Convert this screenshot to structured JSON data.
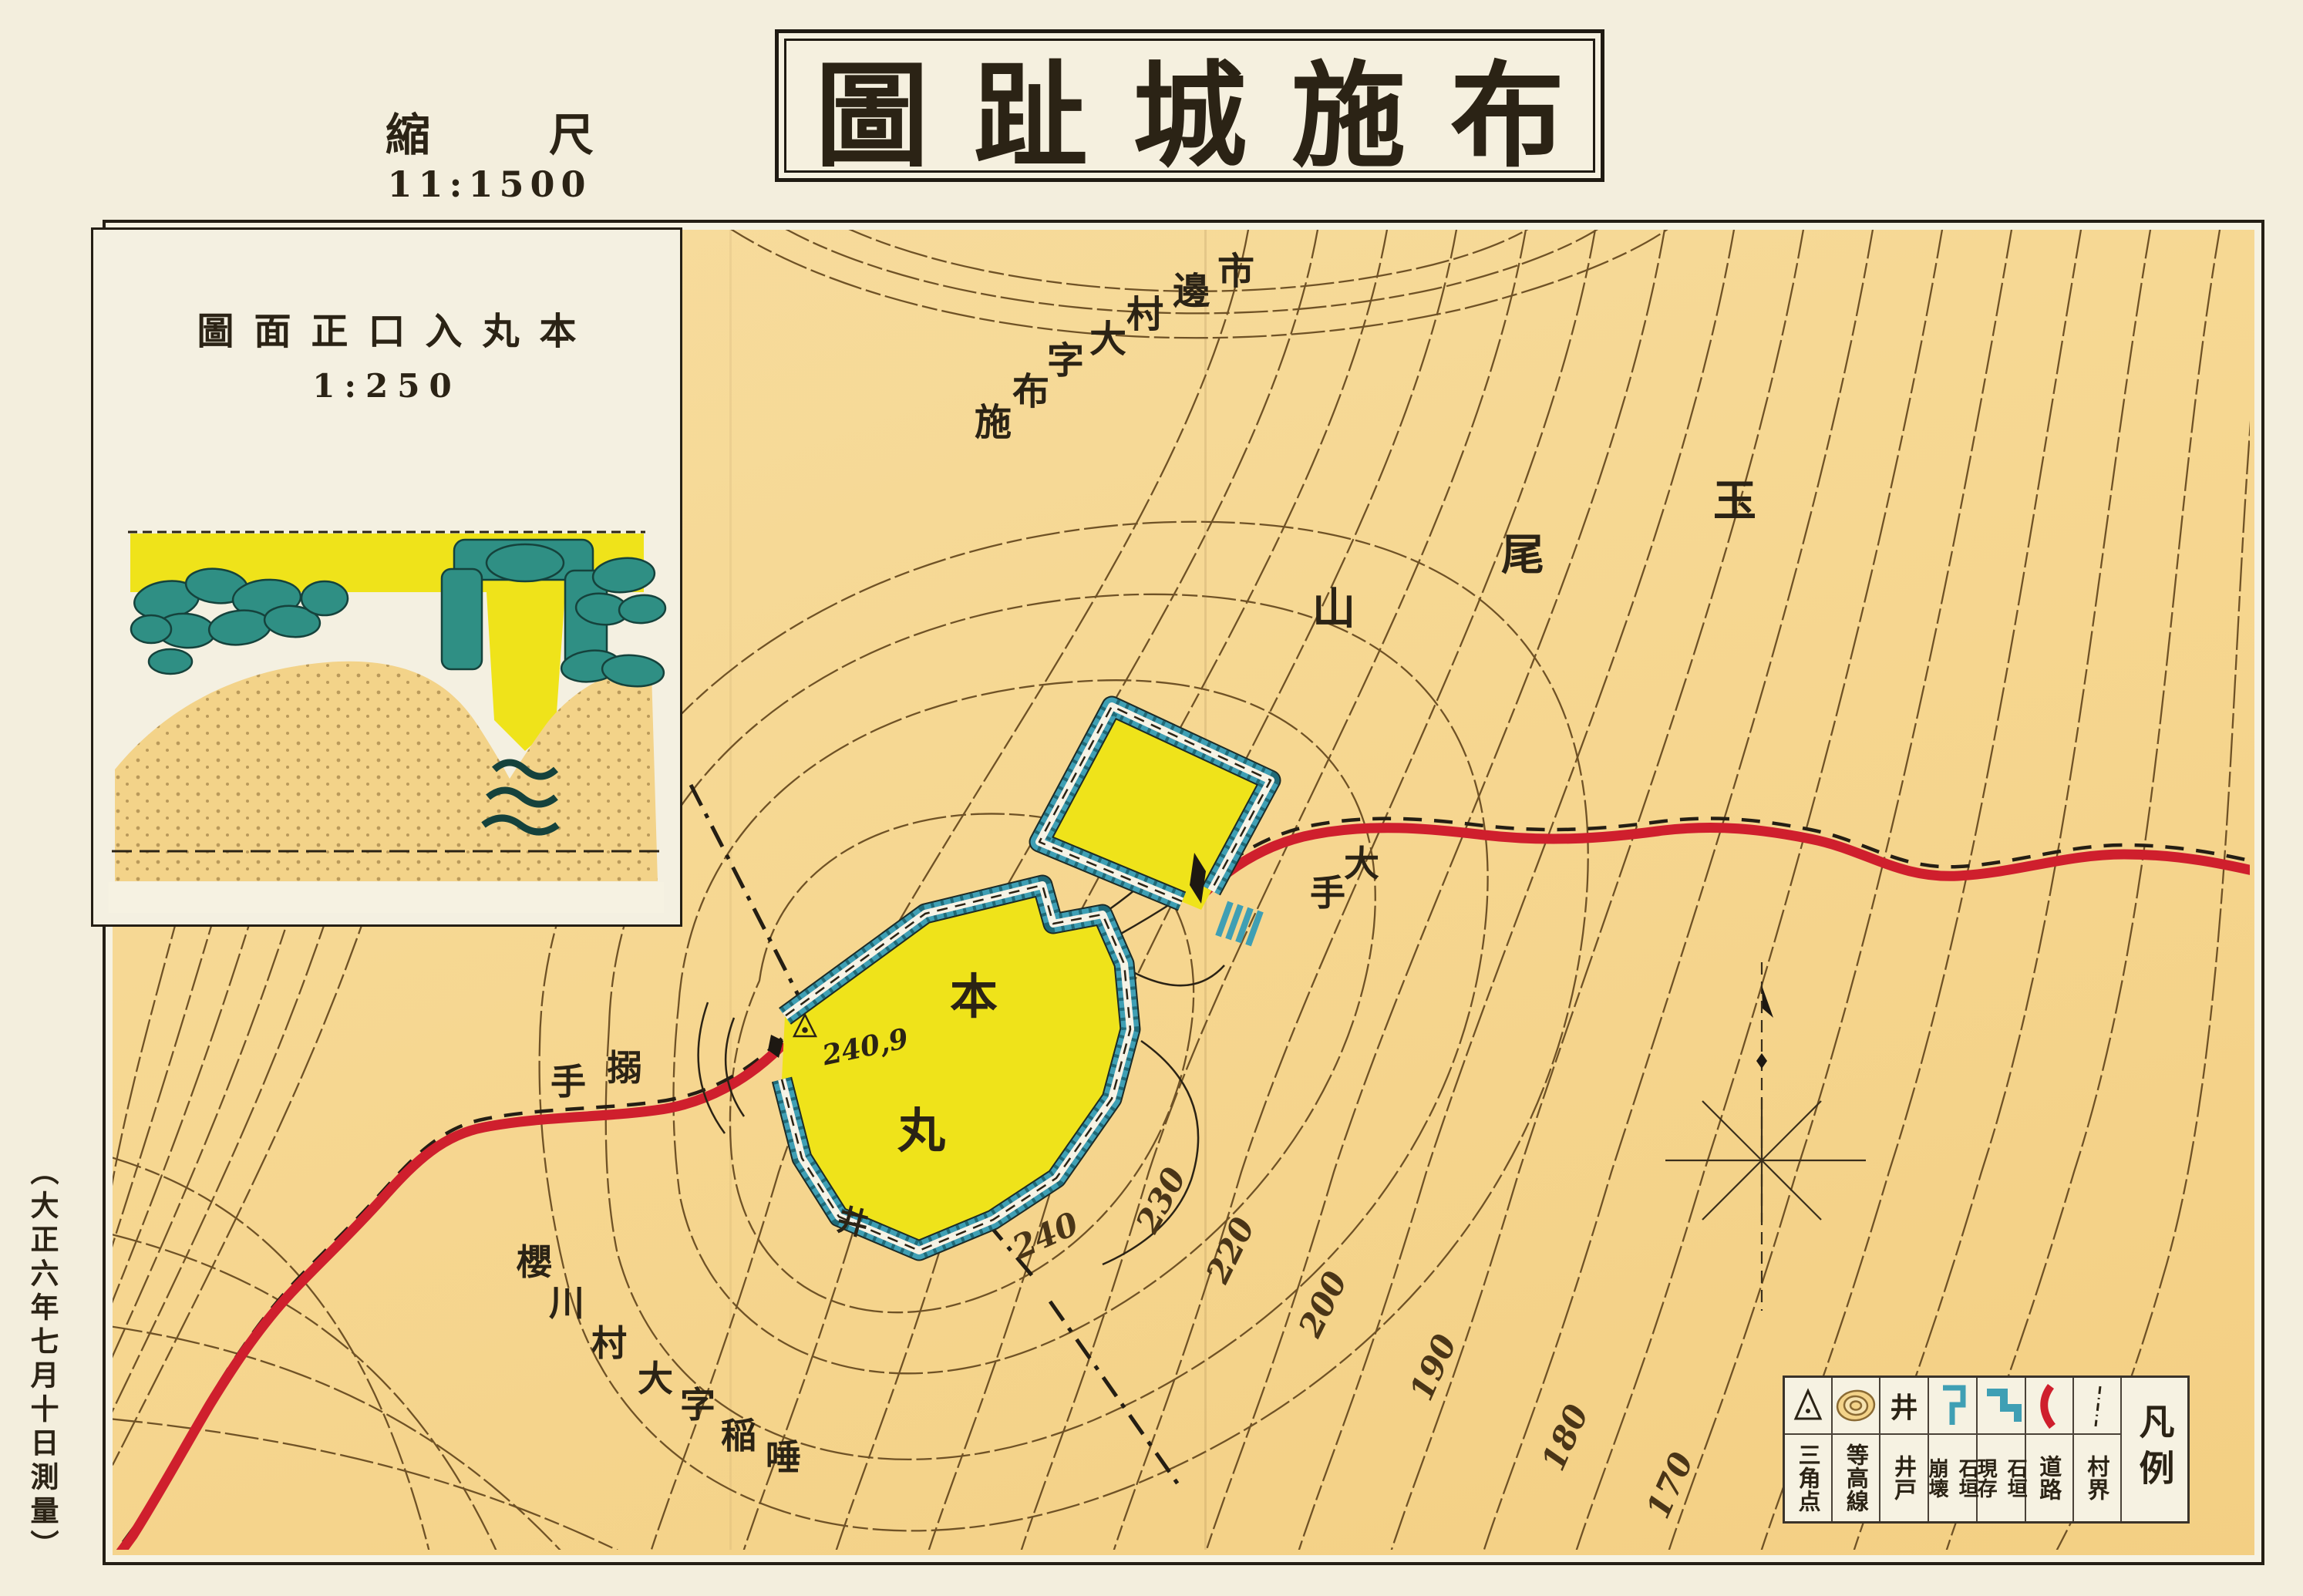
{
  "title": {
    "text": "圖趾城施布"
  },
  "scale": {
    "label_chars": [
      "縮",
      "尺"
    ],
    "value": "11:1500"
  },
  "inset": {
    "title": "圖面正口入丸本",
    "scale": "1:250"
  },
  "survey_note": "（大正六年七月十日測量）",
  "map_labels": {
    "district_upper": [
      "市",
      "邊",
      "村",
      "大",
      "字",
      "布",
      "施"
    ],
    "mountain": [
      "玉",
      "尾",
      "山"
    ],
    "gate_ote": [
      "大",
      "手"
    ],
    "gate_karamete": [
      "搦",
      "手"
    ],
    "honmaru": [
      "本",
      "丸"
    ],
    "district_lower": [
      "櫻",
      "川",
      "村",
      "大",
      "字",
      "稲",
      "唾"
    ],
    "spot_height": "240,9",
    "well_mark": "井"
  },
  "contour_labels": [
    "240",
    "230",
    "220",
    "200",
    "190",
    "180",
    "170"
  ],
  "legend": {
    "title": "凡例",
    "items": [
      {
        "name": "triangulation-point",
        "label": "三角点"
      },
      {
        "name": "contour-lines",
        "label": "等高線"
      },
      {
        "name": "well",
        "label": "井戸",
        "symbol": "井"
      },
      {
        "name": "stone-wall-collapsed",
        "label_right": "石垣",
        "label_left": "崩壊"
      },
      {
        "name": "stone-wall-existing",
        "label_right": "石垣",
        "label_left": "現存"
      },
      {
        "name": "road",
        "label": "道路"
      },
      {
        "name": "village-boundary",
        "label": "村界"
      }
    ]
  },
  "colors": {
    "paper": "#f3eedd",
    "map_ground": "#f6d791",
    "enclosure_yellow": "#efe31a",
    "wall_teal": "#3f9fb4",
    "wall_teal_dark": "#1f6a78",
    "road_red": "#cf1f2d",
    "contour_brown": "#6f5226",
    "ink": "#2b2315"
  }
}
